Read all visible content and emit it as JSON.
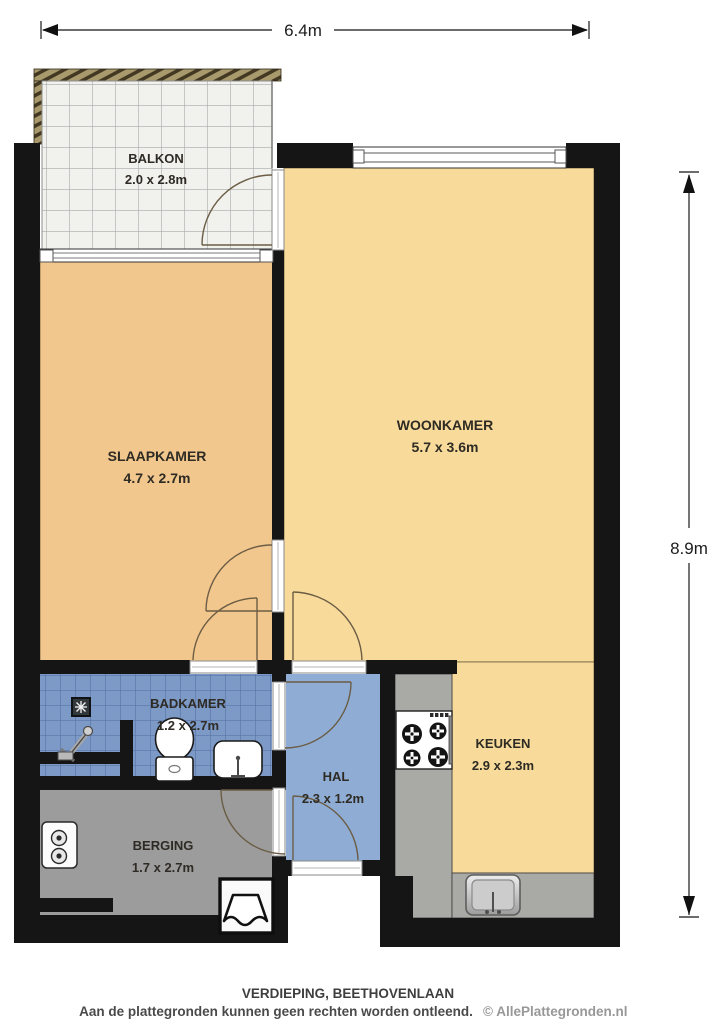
{
  "plan": {
    "dimensions": {
      "width_label": "6.4m",
      "height_label": "8.9m"
    },
    "rooms": {
      "balkon": {
        "name": "BALKON",
        "size": "2.0 x 2.8m"
      },
      "slaapkamer": {
        "name": "SLAAPKAMER",
        "size": "4.7 x 2.7m"
      },
      "woonkamer": {
        "name": "WOONKAMER",
        "size": "5.7 x 3.6m"
      },
      "badkamer": {
        "name": "BADKAMER",
        "size": "1.2 x 2.7m"
      },
      "hal": {
        "name": "HAL",
        "size": "2.3 x 1.2m"
      },
      "keuken": {
        "name": "KEUKEN",
        "size": "2.9 x 2.3m"
      },
      "berging": {
        "name": "BERGING",
        "size": "1.7 x 2.7m"
      }
    },
    "icons": [
      "shower-drain-icon",
      "faucet-icon",
      "toilet-icon",
      "washbasin-icon",
      "stove-icon",
      "kitchen-sink-icon",
      "boiler-icon",
      "washing-machine-icon",
      "dimension-arrow-icon",
      "door-swing-arc",
      "window",
      "balcony-railing"
    ],
    "colors": {
      "wall": "#151515",
      "slaapkamer": "#f2c78d",
      "woonkamer": "#f8db9b",
      "keuken": "#f8db9b",
      "hal": "#8fadd4",
      "badkamer_tile": "#7d99c6",
      "badkamer_grout": "#5a76a8",
      "berging": "#9c9c9c",
      "counter": "#a9a9a5",
      "balkon_tile": "#f1f1ee",
      "railing": "#a89a6d"
    }
  },
  "footer": {
    "title": "VERDIEPING, BEETHOVENLAAN",
    "disclaimer": "Aan de plattegronden kunnen geen rechten worden ontleend.",
    "copyright": "© AllePlattegronden.nl"
  }
}
